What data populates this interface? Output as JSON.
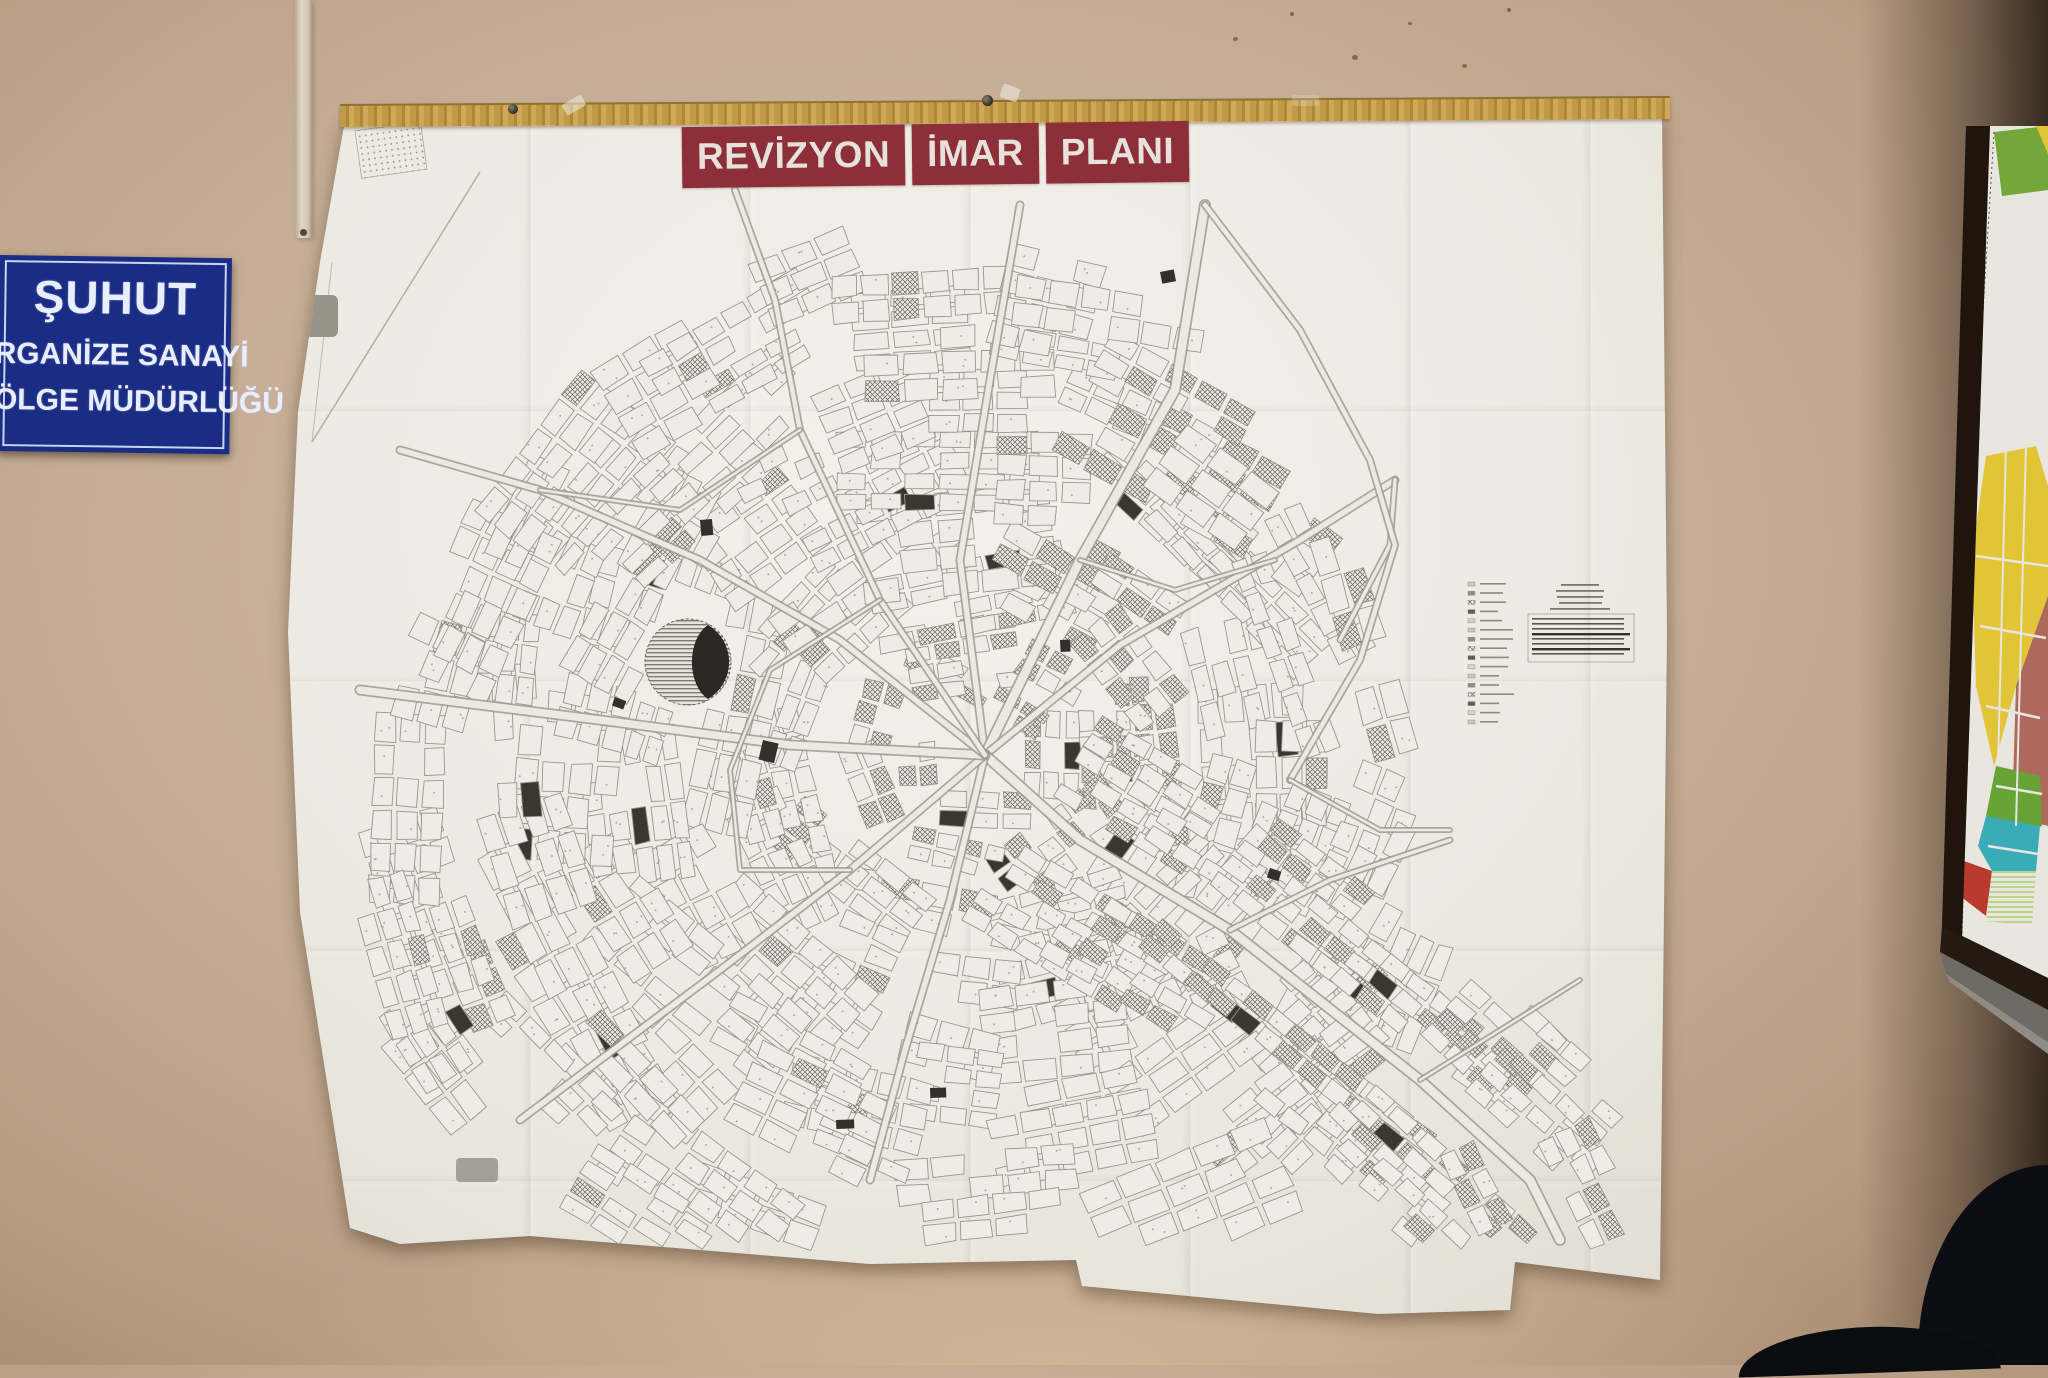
{
  "banner": {
    "words": [
      {
        "label": "REVİZYON"
      },
      {
        "label": "İMAR"
      },
      {
        "label": "PLANI"
      }
    ],
    "bg_color": "#8d2f39",
    "text_color": "#e6e1da"
  },
  "sign": {
    "lines": [
      "ŞUHUT",
      "RGANİZE SANAYİ",
      "ÖLGE MÜDÜRLÜĞÜ"
    ],
    "bg_color": "#1a2c83",
    "text_color": "#e9eeff"
  },
  "colors": {
    "wall": "#c6ae96",
    "wood_strip": "#bf9a44",
    "paper": "#f2f1ec",
    "map_ink": "#8a8781",
    "zoning_colors": [
      "#e2c437",
      "#ad6a5c",
      "#67a335",
      "#3aacb8",
      "#bb3a30",
      "#74a63a"
    ]
  }
}
